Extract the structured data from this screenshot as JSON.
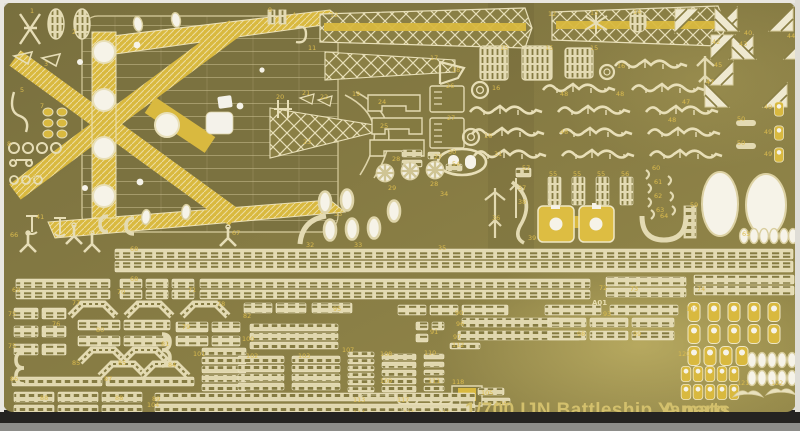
{
  "photo": {
    "subject": "photo-etched detail parts sheet for a plastic model kit",
    "sheet_title": "1/700 IJN Battleship Yamato",
    "sheet_code": "A parts",
    "plate_marking": "A01",
    "colors": {
      "sheet_olive": "#847a41",
      "etch_cream": "#e3dab2",
      "bright_yellow": "#d9b93f",
      "hole_white": "#f6f3e8",
      "label_gold": "#dcbc4e",
      "title_gold": "#d3c06c",
      "table_dark": "#242321"
    },
    "part_numbers": [
      [
        "1",
        30,
        9
      ],
      [
        "2",
        72,
        30
      ],
      [
        "3",
        44,
        62
      ],
      [
        "4",
        292,
        13
      ],
      [
        "5",
        20,
        88
      ],
      [
        "7",
        40,
        104
      ],
      [
        "6",
        32,
        174
      ],
      [
        "8",
        7,
        142
      ],
      [
        "9",
        268,
        8
      ],
      [
        "11",
        308,
        46
      ],
      [
        "12",
        330,
        13
      ],
      [
        "12",
        548,
        12
      ],
      [
        "13",
        590,
        11
      ],
      [
        "14",
        633,
        10
      ],
      [
        "15",
        500,
        46
      ],
      [
        "15",
        545,
        46
      ],
      [
        "15",
        590,
        46
      ],
      [
        "16",
        492,
        86
      ],
      [
        "16",
        484,
        134
      ],
      [
        "16",
        617,
        64
      ],
      [
        "17",
        430,
        56
      ],
      [
        "18",
        452,
        68
      ],
      [
        "19",
        352,
        92
      ],
      [
        "20",
        276,
        95
      ],
      [
        "21",
        302,
        91
      ],
      [
        "22",
        320,
        95
      ],
      [
        "23",
        303,
        140
      ],
      [
        "24",
        378,
        100
      ],
      [
        "25",
        380,
        124
      ],
      [
        "26",
        446,
        84
      ],
      [
        "27",
        447,
        116
      ],
      [
        "27",
        434,
        155
      ],
      [
        "28",
        392,
        157
      ],
      [
        "28",
        430,
        182
      ],
      [
        "29",
        388,
        186
      ],
      [
        "30",
        448,
        150
      ],
      [
        "31",
        494,
        152
      ],
      [
        "32",
        306,
        243
      ],
      [
        "33",
        334,
        212
      ],
      [
        "33",
        354,
        243
      ],
      [
        "34",
        440,
        192
      ],
      [
        "35",
        438,
        246
      ],
      [
        "36",
        492,
        216
      ],
      [
        "37",
        518,
        186
      ],
      [
        "38",
        518,
        200
      ],
      [
        "39",
        528,
        236
      ],
      [
        "40",
        744,
        31
      ],
      [
        "41",
        36,
        215
      ],
      [
        "42",
        712,
        40
      ],
      [
        "43",
        739,
        42
      ],
      [
        "44",
        787,
        34
      ],
      [
        "45",
        714,
        63
      ],
      [
        "47",
        706,
        80
      ],
      [
        "47",
        682,
        100
      ],
      [
        "48",
        560,
        92
      ],
      [
        "48",
        616,
        92
      ],
      [
        "48",
        560,
        130
      ],
      [
        "48",
        668,
        118
      ],
      [
        "49",
        764,
        105
      ],
      [
        "49",
        764,
        130
      ],
      [
        "49",
        764,
        152
      ],
      [
        "50",
        737,
        117
      ],
      [
        "50",
        737,
        141
      ],
      [
        "54",
        452,
        162
      ],
      [
        "55",
        549,
        172
      ],
      [
        "55",
        573,
        172
      ],
      [
        "55",
        597,
        172
      ],
      [
        "56",
        621,
        172
      ],
      [
        "57",
        522,
        166
      ],
      [
        "59",
        690,
        203
      ],
      [
        "60",
        652,
        166
      ],
      [
        "61",
        654,
        180
      ],
      [
        "62",
        654,
        194
      ],
      [
        "63",
        656,
        208
      ],
      [
        "64",
        660,
        214
      ],
      [
        "65",
        742,
        232
      ],
      [
        "66",
        10,
        233
      ],
      [
        "67",
        84,
        231
      ],
      [
        "67",
        232,
        231
      ],
      [
        "68",
        130,
        247
      ],
      [
        "68",
        130,
        277
      ],
      [
        "69",
        12,
        288
      ],
      [
        "70",
        117,
        290
      ],
      [
        "71",
        188,
        288
      ],
      [
        "72",
        599,
        286
      ],
      [
        "73",
        630,
        287
      ],
      [
        "74",
        697,
        287
      ],
      [
        "75",
        8,
        312
      ],
      [
        "75",
        8,
        344
      ],
      [
        "76",
        52,
        322
      ],
      [
        "77",
        72,
        301
      ],
      [
        "78",
        217,
        302
      ],
      [
        "79",
        182,
        325
      ],
      [
        "80",
        96,
        328
      ],
      [
        "81",
        161,
        342
      ],
      [
        "82",
        243,
        314
      ],
      [
        "84",
        168,
        363
      ],
      [
        "85",
        72,
        361
      ],
      [
        "85",
        118,
        361
      ],
      [
        "86",
        10,
        377
      ],
      [
        "87",
        104,
        377
      ],
      [
        "88",
        40,
        396
      ],
      [
        "88",
        115,
        396
      ],
      [
        "89",
        152,
        397
      ],
      [
        "90",
        455,
        311
      ],
      [
        "91",
        430,
        330
      ],
      [
        "93",
        603,
        312
      ],
      [
        "95",
        333,
        307
      ],
      [
        "96",
        456,
        322
      ],
      [
        "97",
        453,
        335
      ],
      [
        "98",
        577,
        332
      ],
      [
        "99",
        633,
        332
      ],
      [
        "100",
        242,
        337
      ],
      [
        "101",
        193,
        352
      ],
      [
        "102",
        246,
        354
      ],
      [
        "103",
        298,
        354
      ],
      [
        "104",
        147,
        403
      ],
      [
        "105",
        481,
        391
      ],
      [
        "106",
        495,
        402
      ],
      [
        "107",
        342,
        348
      ],
      [
        "108",
        380,
        352
      ],
      [
        "109",
        380,
        379
      ],
      [
        "110",
        424,
        351
      ],
      [
        "111",
        428,
        379
      ],
      [
        "112",
        452,
        343
      ],
      [
        "113",
        353,
        398
      ],
      [
        "114",
        353,
        411
      ],
      [
        "115",
        403,
        411
      ],
      [
        "116",
        438,
        411
      ],
      [
        "117",
        397,
        398
      ],
      [
        "118",
        452,
        380
      ],
      [
        "119",
        686,
        307
      ],
      [
        "120",
        678,
        352
      ],
      [
        "121",
        737,
        381
      ],
      [
        "122",
        771,
        381
      ]
    ]
  }
}
